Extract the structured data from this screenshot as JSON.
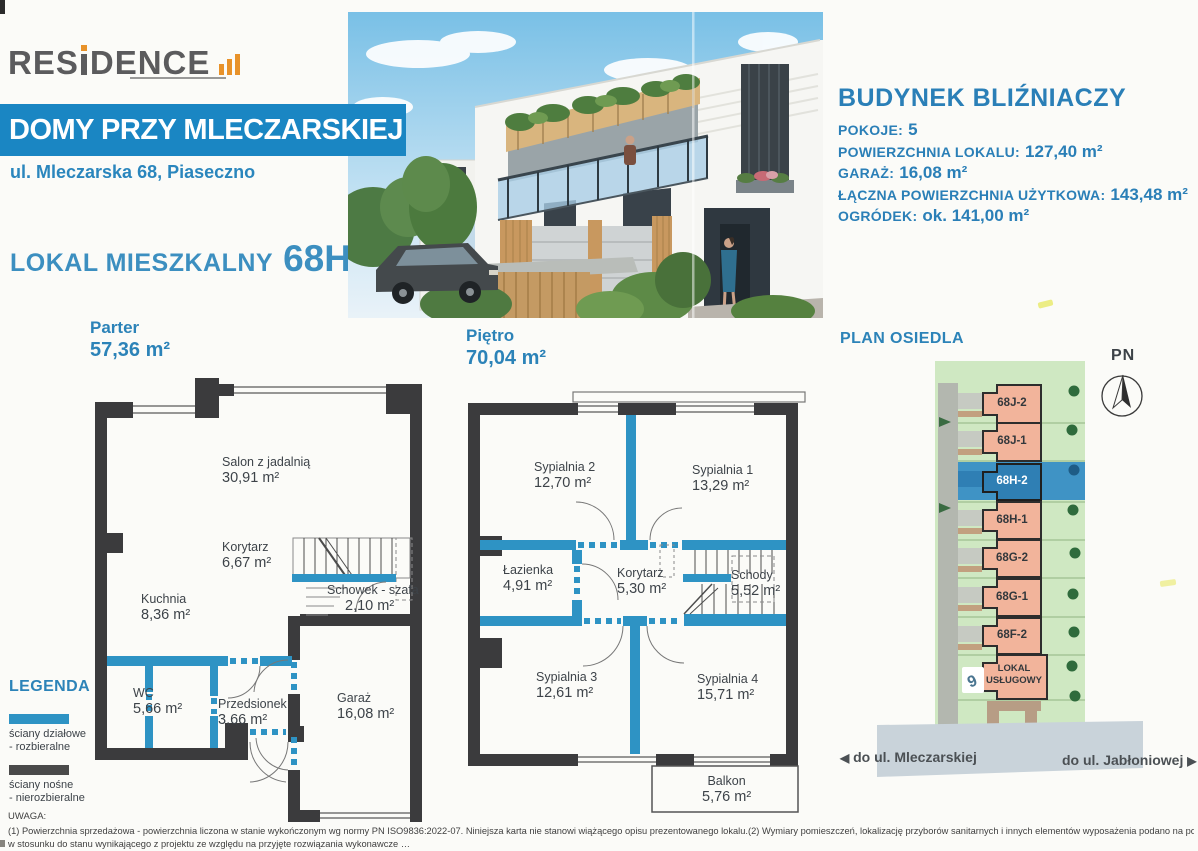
{
  "brand": {
    "logo_left": "RES",
    "logo_right": "DENCE"
  },
  "header": {
    "banner": "DOMY PRZY MLECZARSKIEJ",
    "address": "ul. Mleczarska 68, Piaseczno",
    "unit_label": "LOKAL MIESZKALNY",
    "unit_number": "68H-2"
  },
  "building_info": {
    "title": "BUDYNEK BLIŹNIACZY",
    "rows": [
      {
        "label": "POKOJE:",
        "value": "5"
      },
      {
        "label": "POWIERZCHNIA LOKALU:",
        "value": "127,40 m²"
      },
      {
        "label": "GARAŻ:",
        "value": "16,08 m²"
      },
      {
        "label": "ŁĄCZNA POWIERZCHNIA UŻYTKOWA:",
        "value": "143,48 m²"
      },
      {
        "label": "OGRÓDEK:",
        "value": "ok. 141,00 m²"
      }
    ]
  },
  "floors": {
    "parter": {
      "title": "Parter",
      "area": "57,36 m²",
      "rooms": [
        {
          "name": "Salon z jadalnią",
          "area": "30,91 m²"
        },
        {
          "name": "Korytarz",
          "area": "6,67 m²"
        },
        {
          "name": "Kuchnia",
          "area": "8,36 m²"
        },
        {
          "name": "Schowek - szafa",
          "area": "2,10 m²"
        },
        {
          "name": "WC",
          "area": "5,66 m²"
        },
        {
          "name": "Przedsionek",
          "area": "3,66 m²"
        },
        {
          "name": "Garaż",
          "area": "16,08 m²"
        }
      ]
    },
    "pietro": {
      "title": "Piętro",
      "area": "70,04 m²",
      "rooms": [
        {
          "name": "Sypialnia 2",
          "area": "12,70 m²"
        },
        {
          "name": "Sypialnia 1",
          "area": "13,29 m²"
        },
        {
          "name": "Łazienka",
          "area": "4,91 m²"
        },
        {
          "name": "Korytarz",
          "area": "5,30 m²"
        },
        {
          "name": "Schody",
          "area": "5,52 m²"
        },
        {
          "name": "Sypialnia 3",
          "area": "12,61 m²"
        },
        {
          "name": "Sypialnia 4",
          "area": "15,71 m²"
        },
        {
          "name": "Balkon",
          "area": "5,76 m²"
        }
      ]
    }
  },
  "site_plan": {
    "title": "PLAN OSIEDLA",
    "compass_label": "PN",
    "units": [
      {
        "label": "68J-2"
      },
      {
        "label": "68J-1"
      },
      {
        "label": "68H-2"
      },
      {
        "label": "68H-1"
      },
      {
        "label": "68G-2"
      },
      {
        "label": "68G-1"
      },
      {
        "label": "68F-2"
      },
      {
        "label": "LOKAL USŁUGOWY"
      }
    ],
    "highlighted_unit": "68H-2",
    "arrow_left": "◀",
    "arrow_right": "▶",
    "road_left": "do ul. Mleczarskiej",
    "road_right": "do ul. Jabłoniowej"
  },
  "legend": {
    "title": "LEGENDA",
    "items": [
      {
        "line1": "ściany działowe",
        "line2": "- rozbieralne",
        "color": "#2e93c4"
      },
      {
        "line1": "ściany nośne",
        "line2": "- nierozbieralne",
        "color": "#4a4a4a"
      }
    ]
  },
  "footer": {
    "title": "UWAGA:",
    "line1": "(1) Powierzchnia sprzedażowa - powierzchnia liczona w stanie wykończonym wg normy PN ISO9836:2022-07. Niniejsza karta nie stanowi wiążącego opisu prezentowanego lokalu.(2) Wymiary pomieszczeń, lokalizację przyborów sanitarnych i innych elementów wyposażenia podano na podstawie projektu wykonawczego. W toku budowy mogą wystąpić różnice",
    "line2": "w stosunku do stanu wynikającego z projektu ze względu na przyjęte rozwiązania wykonawcze …"
  },
  "colors": {
    "brand_blue": "#1a86c3",
    "text_blue": "#2a7fb7",
    "wall_dark": "#3b3b3d",
    "partition_blue": "#2e93c4",
    "site_green": "#cfe8c2",
    "site_salmon": "#f2b49b",
    "site_highlight_row": "#3f93c5",
    "site_highlight_unit": "#2f7fb4",
    "road_gray": "#b3b7af",
    "road_bottom": "#c9d3da",
    "logo_orange": "#e8922a"
  }
}
